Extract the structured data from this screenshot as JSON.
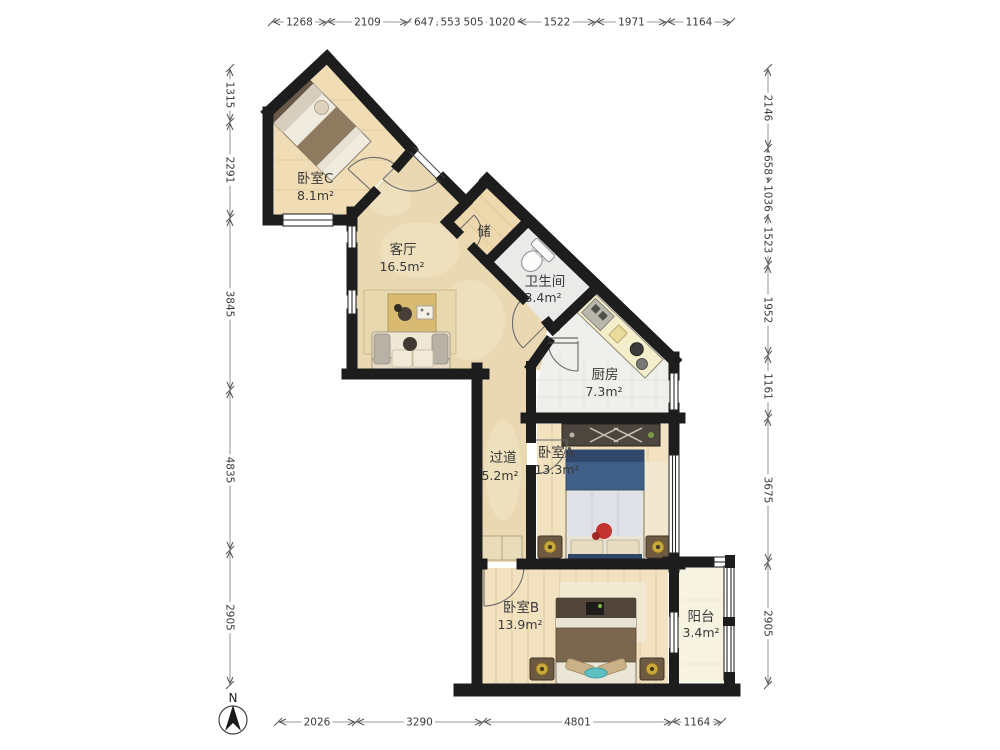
{
  "compass": {
    "label": "N"
  },
  "rooms": {
    "bedroom_c": {
      "name": "卧室C",
      "area": "8.1m²"
    },
    "living": {
      "name": "客厅",
      "area": "16.5m²"
    },
    "storage": {
      "name": "储"
    },
    "bathroom": {
      "name": "卫生间",
      "area": "3.4m²"
    },
    "kitchen": {
      "name": "厨房",
      "area": "7.3m²"
    },
    "hallway": {
      "name": "过道",
      "area": "5.2m²"
    },
    "bedroom_a": {
      "name": "卧室A",
      "area": "13.3m²"
    },
    "bedroom_b": {
      "name": "卧室B",
      "area": "13.9m²"
    },
    "balcony": {
      "name": "阳台",
      "area": "3.4m²"
    }
  },
  "dimensions": {
    "top": [
      "1268",
      "2109",
      "647",
      "553",
      "505",
      "1020",
      "1522",
      "1971",
      "1164"
    ],
    "bottom": [
      "2026",
      "3290",
      "4801",
      "1164"
    ],
    "left": [
      "1315",
      "2291",
      "3845",
      "4835",
      "2905"
    ],
    "right": [
      "2146",
      "658",
      "1036",
      "1523",
      "1952",
      "1161",
      "3675",
      "2905"
    ]
  },
  "colors": {
    "wall": "#1d1d1d",
    "wood_floor": "#f0ddb5",
    "marble_floor": "#e9d8b2",
    "tile_floor": "#ededeb",
    "balcony_floor": "#f7f3e1",
    "bed_blue": "#3f5e88",
    "accent_teal": "#5fc0c2",
    "dimension_text": "#444444"
  }
}
